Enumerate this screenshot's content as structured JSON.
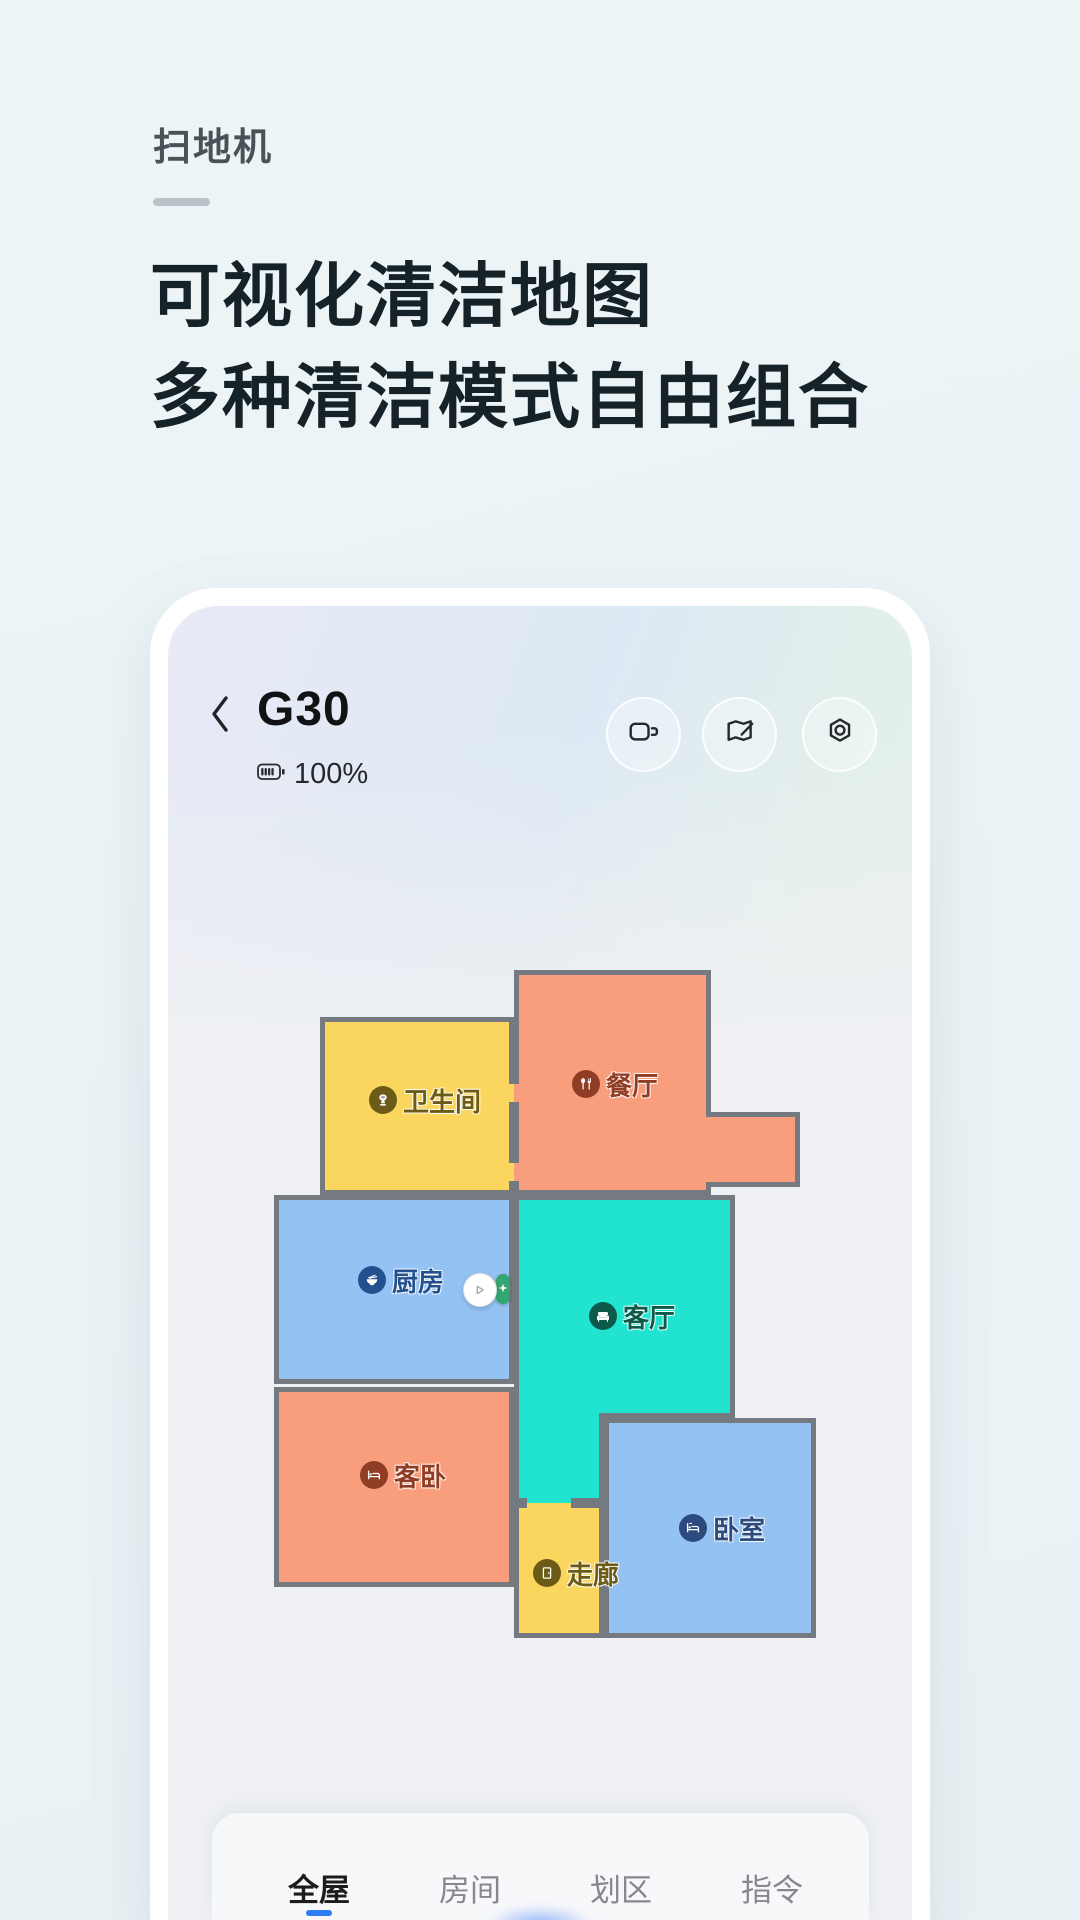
{
  "page": {
    "eyebrow": "扫地机",
    "heading_line1": "可视化清洁地图",
    "heading_line2": "多种清洁模式自由组合",
    "background_top": "#eef5f7",
    "background_bottom": "#e8f1f4"
  },
  "phone": {
    "device_name": "G30",
    "battery": "100%",
    "header_actions": [
      {
        "icon": "video-camera-icon"
      },
      {
        "icon": "map-edit-icon"
      },
      {
        "icon": "settings-icon"
      }
    ],
    "map": {
      "wall_color": "#757a80",
      "background": "#eef0f3",
      "rooms": [
        {
          "name": "餐厅",
          "color": "#f99e7d",
          "label_color": "#8f3d24",
          "icon": "cutlery-icon"
        },
        {
          "name": "卫生间",
          "color": "#fbd65e",
          "label_color": "#6b5b17",
          "icon": "toilet-icon"
        },
        {
          "name": "厨房",
          "color": "#94c2f3",
          "label_color": "#23518f",
          "icon": "bowl-icon"
        },
        {
          "name": "客厅",
          "color": "#20e4d0",
          "label_color": "#0d594a",
          "icon": "sofa-icon"
        },
        {
          "name": "客卧",
          "color": "#f99e7d",
          "label_color": "#8f3d24",
          "icon": "bed-icon"
        },
        {
          "name": "走廊",
          "color": "#fbd65e",
          "label_color": "#6b5b17",
          "icon": "door-icon"
        },
        {
          "name": "卧室",
          "color": "#94c2f3",
          "label_color": "#2c4a7c",
          "icon": "bed-lamp-icon"
        }
      ],
      "robot": {
        "icon": "robot-vacuum-icon",
        "dock_color": "#33a673"
      }
    },
    "tabs": [
      {
        "label": "全屋",
        "active": true
      },
      {
        "label": "房间",
        "active": false
      },
      {
        "label": "划区",
        "active": false
      },
      {
        "label": "指令",
        "active": false
      }
    ],
    "tab_active_color": "#2d7df7"
  }
}
